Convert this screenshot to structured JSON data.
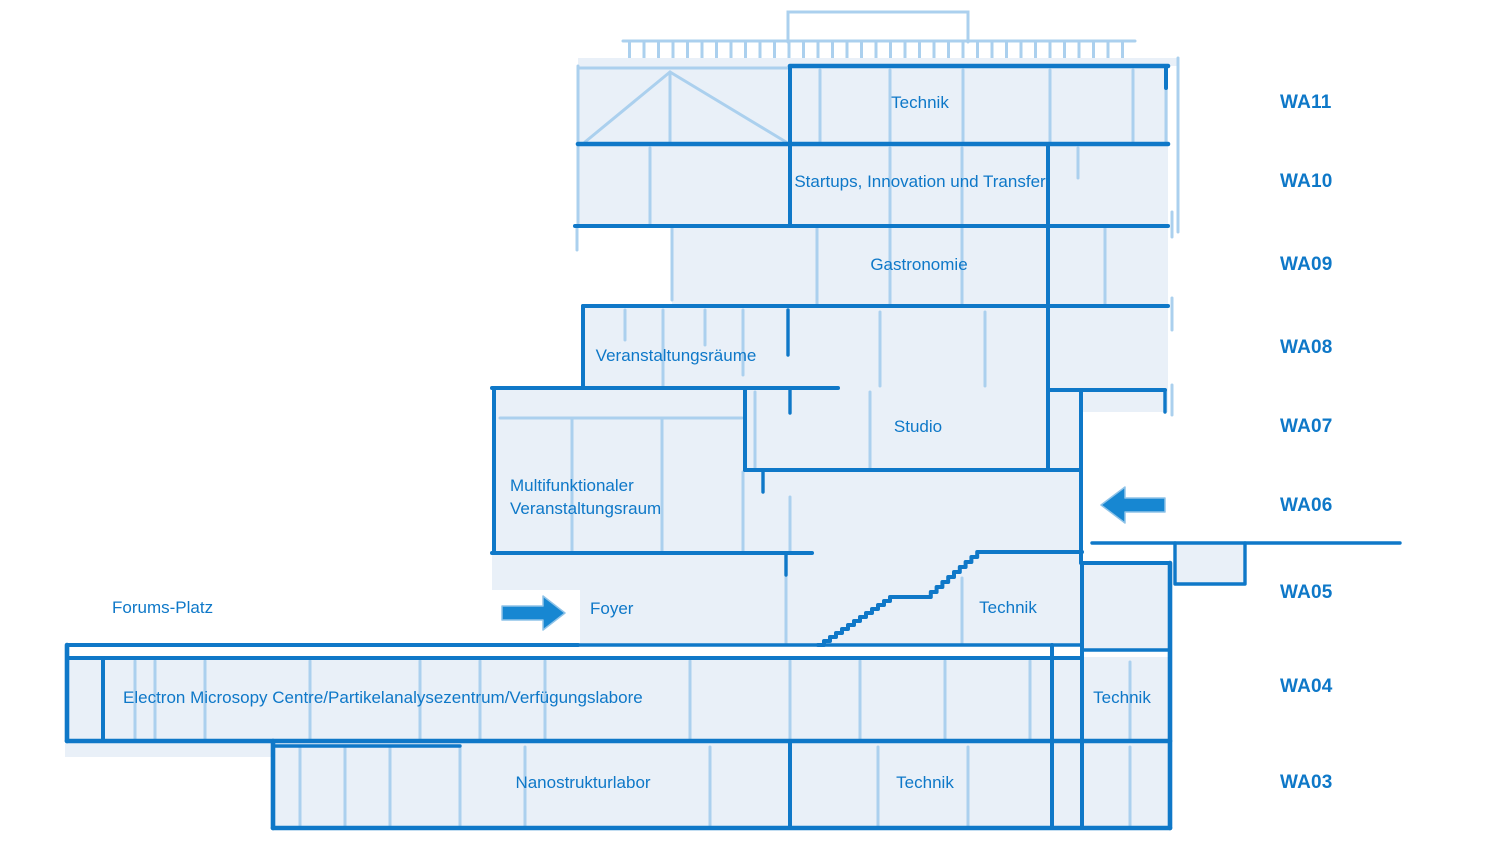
{
  "diagram_title": "Building section with floor levels",
  "floors": [
    {
      "code": "WA11"
    },
    {
      "code": "WA10"
    },
    {
      "code": "WA09"
    },
    {
      "code": "WA08"
    },
    {
      "code": "WA07"
    },
    {
      "code": "WA06"
    },
    {
      "code": "WA05"
    },
    {
      "code": "WA04"
    },
    {
      "code": "WA03"
    }
  ],
  "rooms": {
    "wa11_technik": "Technik",
    "wa10_startups": "Startups, Innovation und Transfer",
    "wa09_gastronomie": "Gastronomie",
    "wa08_veranstaltungsraeume": "Veranstaltungsräume",
    "wa07_studio": "Studio",
    "wa06_multifunktional_line1": "Multifunktionaler",
    "wa06_multifunktional_line2": "Veranstaltungsraum",
    "forums_platz": "Forums-Platz",
    "foyer": "Foyer",
    "wa05_technik": "Technik",
    "wa04_labs": "Electron Microsopy Centre/Partikelanalysezentrum/Verfügungslabore",
    "wa04_technik": "Technik",
    "wa03_nanostrukturlabor": "Nanostrukturlabor",
    "wa03_technik": "Technik"
  },
  "icons": {
    "entrance_arrow_foyer": "arrow-right",
    "entrance_arrow_wa06": "arrow-left"
  },
  "colors": {
    "line_dark": "#0f78c8",
    "line_light": "#abd0ee",
    "fill_pale": "#e9f0f8",
    "text": "#0e78c8",
    "arrow": "#1787d2"
  }
}
